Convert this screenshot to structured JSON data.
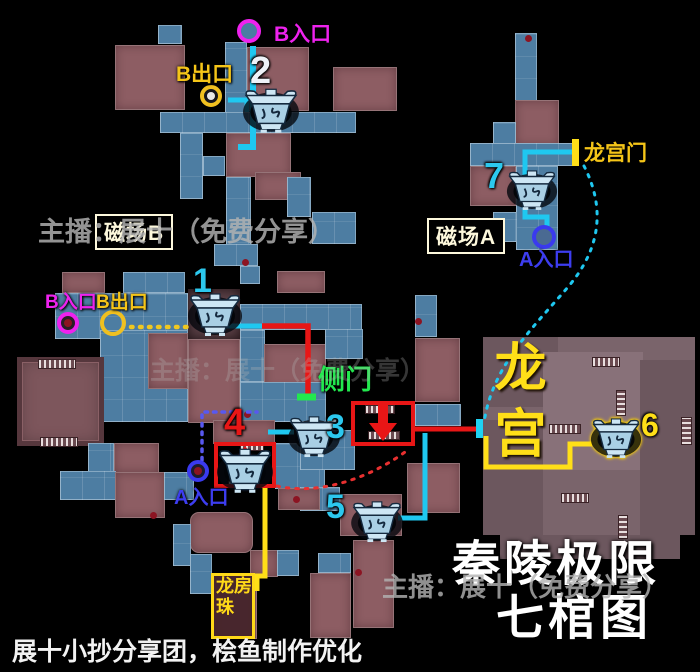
{
  "title": {
    "line1": "秦陵极限",
    "line2": "七棺图"
  },
  "credit": "展十小抄分享团，桧鱼制作优化",
  "watermark": "主播：展十（免费分享）",
  "labels": {
    "b_entrance": "B入口",
    "b_exit": "B出口",
    "a_entrance": "A入口",
    "field_b": "磁场B",
    "field_a": "磁场A",
    "dragon_palace_gate": "龙宫门",
    "side_door": "侧门",
    "dragon_palace": "龙宫",
    "dragon_pearl_room": "龙珠房"
  },
  "colors": {
    "cyan_path": "#1fc8f0",
    "yellow_path": "#ffdf18",
    "red_path": "#e81616",
    "green_accent": "#22e84e",
    "magenta_accent": "#ee22ee",
    "blue_accent": "#3d3df0",
    "tile_blue": "#4d7da2",
    "tile_maroon": "#8d5d63",
    "palace_mauve": "#7a646b"
  },
  "map": {
    "tiles": [
      [
        158,
        25,
        24,
        19,
        "b"
      ],
      [
        115,
        45,
        70,
        65,
        "m"
      ],
      [
        225,
        42,
        22,
        73,
        "b"
      ],
      [
        247,
        47,
        62,
        64,
        "m"
      ],
      [
        333,
        67,
        64,
        44,
        "m"
      ],
      [
        160,
        112,
        196,
        21,
        "b"
      ],
      [
        180,
        133,
        23,
        66,
        "b"
      ],
      [
        226,
        133,
        65,
        44,
        "m"
      ],
      [
        255,
        172,
        46,
        28,
        "m"
      ],
      [
        226,
        177,
        25,
        88,
        "b"
      ],
      [
        287,
        177,
        24,
        40,
        "b"
      ],
      [
        203,
        156,
        22,
        20,
        "b"
      ],
      [
        312,
        212,
        44,
        32,
        "b"
      ],
      [
        214,
        244,
        44,
        22,
        "b"
      ],
      [
        240,
        266,
        20,
        18,
        "b"
      ],
      [
        515,
        33,
        22,
        68,
        "b"
      ],
      [
        515,
        100,
        44,
        46,
        "m"
      ],
      [
        493,
        122,
        23,
        24,
        "b"
      ],
      [
        470,
        143,
        108,
        23,
        "b"
      ],
      [
        470,
        166,
        46,
        40,
        "m"
      ],
      [
        516,
        166,
        42,
        84,
        "b"
      ],
      [
        493,
        212,
        24,
        30,
        "b"
      ],
      [
        62,
        272,
        43,
        21,
        "m"
      ],
      [
        123,
        272,
        62,
        21,
        "b"
      ],
      [
        277,
        271,
        48,
        22,
        "m"
      ],
      [
        55,
        293,
        133,
        46,
        "b"
      ],
      [
        188,
        289,
        52,
        50,
        "d"
      ],
      [
        240,
        304,
        122,
        26,
        "b"
      ],
      [
        100,
        330,
        88,
        92,
        "b"
      ],
      [
        148,
        333,
        40,
        56,
        "m"
      ],
      [
        188,
        339,
        52,
        84,
        "m"
      ],
      [
        240,
        330,
        25,
        52,
        "b"
      ],
      [
        264,
        344,
        62,
        46,
        "m"
      ],
      [
        240,
        382,
        86,
        40,
        "b"
      ],
      [
        17,
        357,
        87,
        89,
        "m2"
      ],
      [
        325,
        329,
        38,
        30,
        "b"
      ],
      [
        88,
        443,
        26,
        30,
        "b"
      ],
      [
        114,
        443,
        45,
        30,
        "m"
      ],
      [
        60,
        471,
        56,
        29,
        "b"
      ],
      [
        115,
        472,
        50,
        46,
        "m"
      ],
      [
        164,
        472,
        30,
        28,
        "b"
      ],
      [
        213,
        420,
        62,
        24,
        "m"
      ],
      [
        275,
        443,
        50,
        46,
        "b"
      ],
      [
        300,
        430,
        55,
        40,
        "b"
      ],
      [
        415,
        295,
        22,
        42,
        "b"
      ],
      [
        415,
        338,
        45,
        64,
        "m"
      ],
      [
        415,
        404,
        46,
        22,
        "b"
      ],
      [
        407,
        463,
        53,
        50,
        "m"
      ],
      [
        190,
        512,
        63,
        41,
        "m",
        "round"
      ],
      [
        173,
        524,
        18,
        42,
        "b"
      ],
      [
        190,
        554,
        22,
        40,
        "b"
      ],
      [
        250,
        550,
        28,
        27,
        "m"
      ],
      [
        277,
        550,
        22,
        26,
        "b"
      ],
      [
        318,
        553,
        33,
        20,
        "b"
      ],
      [
        310,
        573,
        41,
        65,
        "m"
      ],
      [
        353,
        540,
        41,
        88,
        "m"
      ],
      [
        300,
        487,
        40,
        24,
        "b"
      ],
      [
        340,
        494,
        62,
        42,
        "m"
      ],
      [
        278,
        488,
        42,
        22,
        "m"
      ],
      [
        213,
        575,
        44,
        64,
        "m"
      ],
      [
        483,
        337,
        212,
        198,
        "L"
      ],
      [
        483,
        337,
        75,
        70,
        "L2"
      ],
      [
        543,
        352,
        100,
        118,
        "L3"
      ],
      [
        640,
        360,
        55,
        175,
        "L2"
      ],
      [
        483,
        420,
        60,
        115,
        "L2"
      ],
      [
        500,
        535,
        180,
        24,
        "L2"
      ]
    ],
    "ladders": [
      [
        592,
        357,
        26,
        8,
        ""
      ],
      [
        616,
        390,
        8,
        24,
        "v"
      ],
      [
        549,
        424,
        30,
        8,
        ""
      ],
      [
        681,
        417,
        9,
        26,
        "v"
      ],
      [
        561,
        493,
        26,
        8,
        ""
      ],
      [
        618,
        515,
        8,
        22,
        "v"
      ],
      [
        365,
        405,
        28,
        7,
        ""
      ],
      [
        368,
        431,
        30,
        7,
        ""
      ],
      [
        228,
        477,
        30,
        7,
        ""
      ],
      [
        240,
        443,
        22,
        6,
        ""
      ],
      [
        38,
        359,
        36,
        8,
        ""
      ],
      [
        40,
        437,
        36,
        8,
        ""
      ]
    ],
    "red_dots": [
      [
        247,
        414
      ],
      [
        296,
        499
      ],
      [
        153,
        515
      ],
      [
        418,
        321
      ],
      [
        528,
        38
      ],
      [
        245,
        262
      ],
      [
        358,
        572
      ]
    ]
  },
  "routes": [
    {
      "d": "M253,46 L253,147 L238,147",
      "c": "#1fc8f0",
      "w": 6
    },
    {
      "d": "M228,100 L247,100 L247,112",
      "c": "#1fc8f0",
      "w": 5
    },
    {
      "d": "M131,327 L192,327",
      "c": "#f0c820",
      "w": 4.5,
      "dash": "1.5,7.5"
    },
    {
      "d": "M220,326 L264,326",
      "c": "#1fc8f0",
      "w": 5
    },
    {
      "d": "M262,326 L308,326 L308,395",
      "c": "#e81616",
      "w": 5.5
    },
    {
      "d": "M297,397 L316,397",
      "c": "#22e84e",
      "w": 7
    },
    {
      "d": "M268,432 L294,432",
      "c": "#1fc8f0",
      "w": 5
    },
    {
      "d": "M415,429 L479,429",
      "c": "#e81616",
      "w": 5
    },
    {
      "d": "M425,433 L425,518 L398,518",
      "c": "#1fc8f0",
      "w": 5
    },
    {
      "d": "M486,436 L486,467 L570,467 L570,444 L592,444",
      "c": "#ffdf18",
      "w": 5
    },
    {
      "d": "M577,152 L525,152 L525,217 L547,217 L547,229",
      "c": "#1fc8f0",
      "w": 5
    },
    {
      "d": "M584,166 C604,205 603,246 568,287 C532,329 492,366 484,423",
      "c": "#1fc8f0",
      "w": 3,
      "dash": "2.5,7"
    },
    {
      "d": "M202,460 L202,412 L257,412",
      "c": "#5858f0",
      "w": 3.5,
      "dash": "2.5,6"
    },
    {
      "d": "M277,486 C320,496 373,477 409,449",
      "c": "#e83030",
      "w": 3,
      "dash": "2.5,7"
    },
    {
      "d": "M265,485 L265,576 L257,576 L257,591",
      "c": "#ffdf18",
      "w": 5
    },
    {
      "d": "M245,446 L231,464 L259,464 Z",
      "fill": "#e81616"
    },
    {
      "d": "M240,464 L250,464 L250,482 L240,482 Z",
      "fill": "#e81616"
    },
    {
      "d": "M383,441 L369,423 L397,423 Z",
      "fill": "#e81616"
    },
    {
      "d": "M378,405 L388,405 L388,423 L378,423 Z",
      "fill": "#e81616"
    }
  ],
  "red_boxes": [
    {
      "x": 214,
      "y": 442,
      "w": 62,
      "h": 46,
      "name": "coffin-4-drop-box"
    },
    {
      "x": 351,
      "y": 401,
      "w": 64,
      "h": 45,
      "name": "side-door-drop-box"
    }
  ],
  "bars": [
    {
      "x": 476,
      "y": 419,
      "w": 7,
      "h": 19,
      "c": "#1fd2f2",
      "name": "palace-entrance-marker"
    },
    {
      "x": 572,
      "y": 139,
      "w": 7,
      "h": 27,
      "c": "#ffdf18",
      "name": "dragon-gate-marker"
    }
  ],
  "markers": {
    "circles": [
      {
        "cx": 253,
        "cy": 35,
        "r": 12,
        "ring": "#ee22ee",
        "fill": "#4a7da2",
        "dot": "",
        "name": "b-entrance-top-circle"
      },
      {
        "cx": 215,
        "cy": 100,
        "r": 11,
        "ring": "#f0c020",
        "fill": "#15151c",
        "dot": "#e8e8e8",
        "name": "b-exit-top-circle"
      },
      {
        "cx": 72,
        "cy": 327,
        "r": 11,
        "ring": "#ee22ee",
        "fill": "#2a1e26",
        "dot": "#8c1422",
        "name": "b-entrance-left-circle"
      },
      {
        "cx": 117,
        "cy": 327,
        "r": 13,
        "ring": "#f0c020",
        "fill": "",
        "dot": "",
        "name": "b-exit-left-circle"
      },
      {
        "cx": 202,
        "cy": 475,
        "r": 11,
        "ring": "#3a3aee",
        "fill": "#1c1c2e",
        "dot": "#8c1422",
        "name": "a-entrance-bottom-circle"
      },
      {
        "cx": 548,
        "cy": 241,
        "r": 12,
        "ring": "#3a3aee",
        "fill": "#4a6a92",
        "dot": "",
        "name": "a-entrance-right-circle"
      }
    ],
    "numbers": [
      {
        "x": 250,
        "y": 52,
        "t": "2",
        "c": "#eef2f8",
        "s": 38
      },
      {
        "x": 193,
        "y": 264,
        "t": "1",
        "c": "#2cc8ee",
        "s": 34
      },
      {
        "x": 326,
        "y": 410,
        "t": "3",
        "c": "#2cc8ee",
        "s": 34
      },
      {
        "x": 224,
        "y": 404,
        "t": "4",
        "c": "#e81616",
        "s": 38
      },
      {
        "x": 326,
        "y": 490,
        "t": "5",
        "c": "#2cc8ee",
        "s": 34
      },
      {
        "x": 641,
        "y": 409,
        "t": "6",
        "c": "#ffdf18",
        "s": 32
      },
      {
        "x": 484,
        "y": 158,
        "t": "7",
        "c": "#2cc8ee",
        "s": 36
      }
    ]
  },
  "coffins": [
    {
      "x": 187,
      "y": 291,
      "w": 56,
      "sel": false,
      "label": "coffin-1"
    },
    {
      "x": 242,
      "y": 86,
      "w": 58,
      "sel": false,
      "label": "coffin-2"
    },
    {
      "x": 287,
      "y": 414,
      "w": 54,
      "sel": false,
      "label": "coffin-3"
    },
    {
      "x": 216,
      "y": 446,
      "w": 58,
      "sel": false,
      "label": "coffin-4"
    },
    {
      "x": 350,
      "y": 499,
      "w": 54,
      "sel": false,
      "label": "coffin-5"
    },
    {
      "x": 590,
      "y": 416,
      "w": 52,
      "sel": true,
      "label": "coffin-6"
    },
    {
      "x": 506,
      "y": 168,
      "w": 52,
      "sel": false,
      "label": "coffin-7"
    }
  ]
}
